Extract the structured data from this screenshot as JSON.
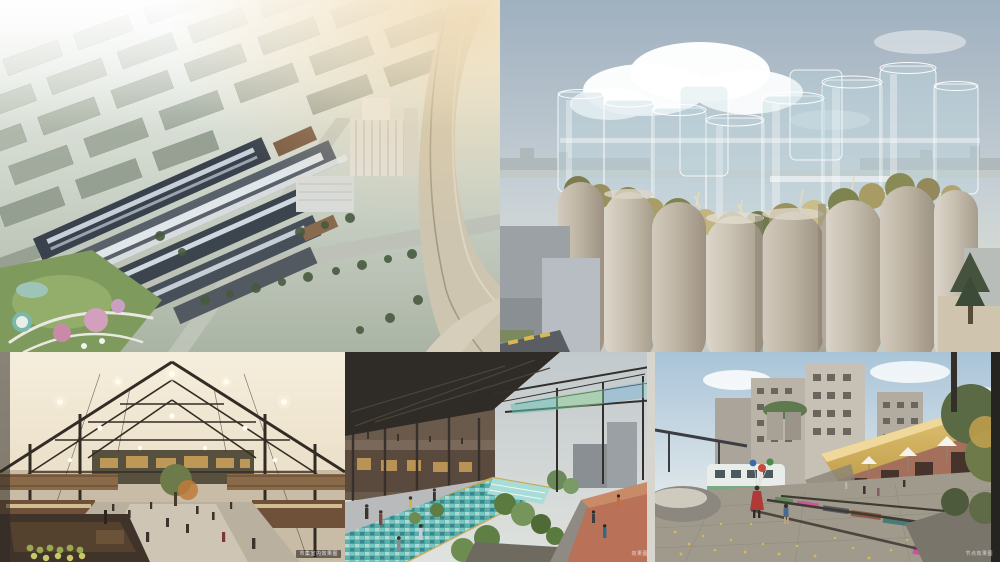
{
  "collage": {
    "type": "architectural-rendering-collage",
    "panel_count": 5,
    "layout": {
      "width_px": 1000,
      "height_px": 562,
      "top_row_height_px": 352,
      "bottom_row_height_px": 210
    },
    "panels": [
      {
        "id": "aerial-masterplan",
        "position": "top-left",
        "alt": "Aerial bird's-eye render of an industrial campus regeneration: long sawtooth-roofed factory halls with white skylight bands, a tall white silo building, surrounding rows of grey-green city blocks fading into haze, a curved elevated highway on the right and a colourful park at lower left",
        "caption": ""
      },
      {
        "id": "silo-towers",
        "position": "top-right",
        "alt": "Eye-level render of a cluster of concrete grain silos crowned with transparent glass cylinders; trees and golden shrubs grow on the silo tops; large white cloud in a blue-grey sky, hazy city skyline at the horizon, low grey buildings at lower left",
        "caption": ""
      },
      {
        "id": "market-hall-interior",
        "position": "bottom-left",
        "alt": "Interior render of a market hall under a dark steel gabled frame with translucent ivory roof panels, hexagonal pendant lights, timber mezzanines and stalls, a central tree and shoppers; produce stall in the dark lower-left foreground",
        "caption": "市集室内效果图"
      },
      {
        "id": "water-channel-walkway",
        "position": "bottom-middle",
        "alt": "Render of a linear mosaic-tiled water channel running between two-storey brick shop buildings under a large dark canopy on the left and a steel pergola with tinted green-blue glass overhead; terracotta jogging ramp with pedestrians on the right",
        "caption": "效果图"
      },
      {
        "id": "railway-plaza",
        "position": "bottom-right",
        "alt": "Render of a plaza over preserved railway tracks with brightly painted sleepers and scattered ginkgo leaves; children and a woman holding balloons, a white heritage train car, a thatched-roof brick warehouse with white umbrellas, and tall concrete silo towers behind",
        "caption": "节点效果图"
      }
    ],
    "palette": {
      "sky_blue": "#aab9c6",
      "haze_white": "#eef0ee",
      "concrete_warm": "#c2b8a8",
      "glass_teal": "#bcd8e0",
      "vegetation_olive": "#8a8a56",
      "steel_dark": "#2f2b27",
      "timber_brown": "#8a6a48",
      "canal_teal": "#5fb3ac",
      "ramp_terracotta": "#b97257",
      "thatch_gold": "#d2b266",
      "sleeper_pink": "#c9579a",
      "ginkgo_yellow": "#d9b850",
      "city_green_grey": "#96a092"
    }
  }
}
